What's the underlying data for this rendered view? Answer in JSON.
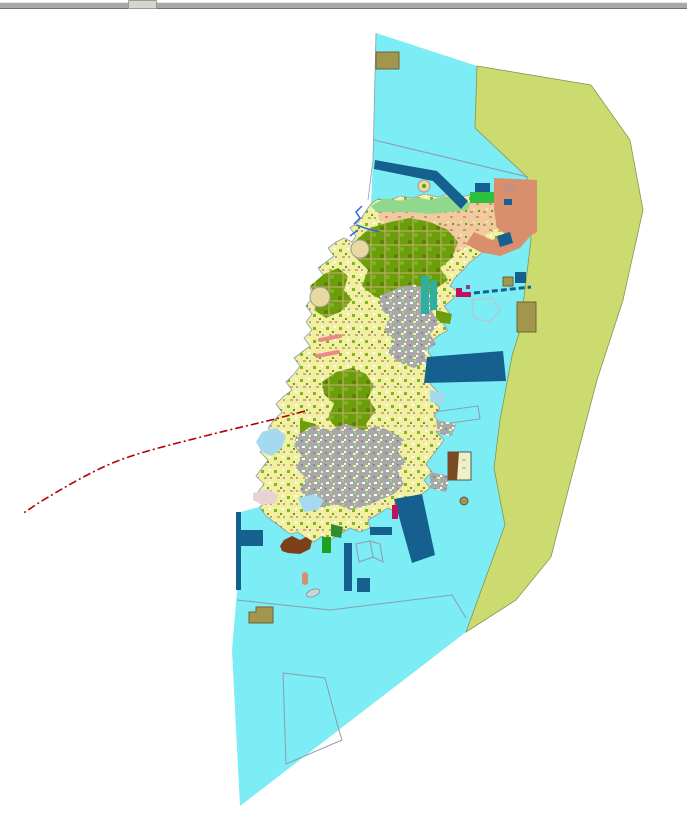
{
  "window": {
    "top_edge_color": "#a8a8a8",
    "top_handle_color": "#d8d5ce"
  },
  "colors": {
    "background": "#ffffff",
    "water": "#7cecf5",
    "offshore_zone": "#ccdb70",
    "island_base": "#f2efa0",
    "north_plain": "#f0cba0",
    "salmon_district": "#d98f6c",
    "forest": "#6c9e0c",
    "forest_dark": "#587f08",
    "forest_light": "#7fb526",
    "urban": "#a8a8a8",
    "urban_dark": "#8a8a8a",
    "coastal_green": "#8fd98f",
    "green_parcel": "#2fbf3f",
    "green_bright": "#1fa020",
    "teal_parcel": "#2fafa0",
    "pale_blue": "#a5d9f0",
    "pale_pink": "#e8d4d4",
    "navy": "#15608f",
    "khaki": "#a2954d",
    "khaki_border": "#6e6530",
    "brown": "#7e4018",
    "brown_dark": "#7a4a22",
    "cream": "#efefc8",
    "crimson": "#c01060",
    "purple": "#8040a0",
    "red_boundary": "#b40000",
    "pink_road": "#ee8888",
    "stream_blue": "#2e6bd9",
    "zone_line": "#8c9ca8",
    "tan_circle": "#e8d9a0",
    "tan_grid": "#c9b070",
    "white": "#ffffff",
    "speckle_yellow": "#f2efa0"
  },
  "features": [
    {
      "name": "coastal-water",
      "color": "#7cecf5"
    },
    {
      "name": "offshore-zone",
      "color": "#ccdb70"
    },
    {
      "name": "island-landuse-mosaic",
      "color": "#f2efa0"
    },
    {
      "name": "forest-patches",
      "color": "#6c9e0c"
    },
    {
      "name": "urban-areas",
      "color": "#a8a8a8"
    },
    {
      "name": "harbor-structures",
      "color": "#15608f"
    },
    {
      "name": "special-parcels",
      "color": "#a2954d"
    },
    {
      "name": "territorial-boundary",
      "color": "#b40000"
    }
  ]
}
